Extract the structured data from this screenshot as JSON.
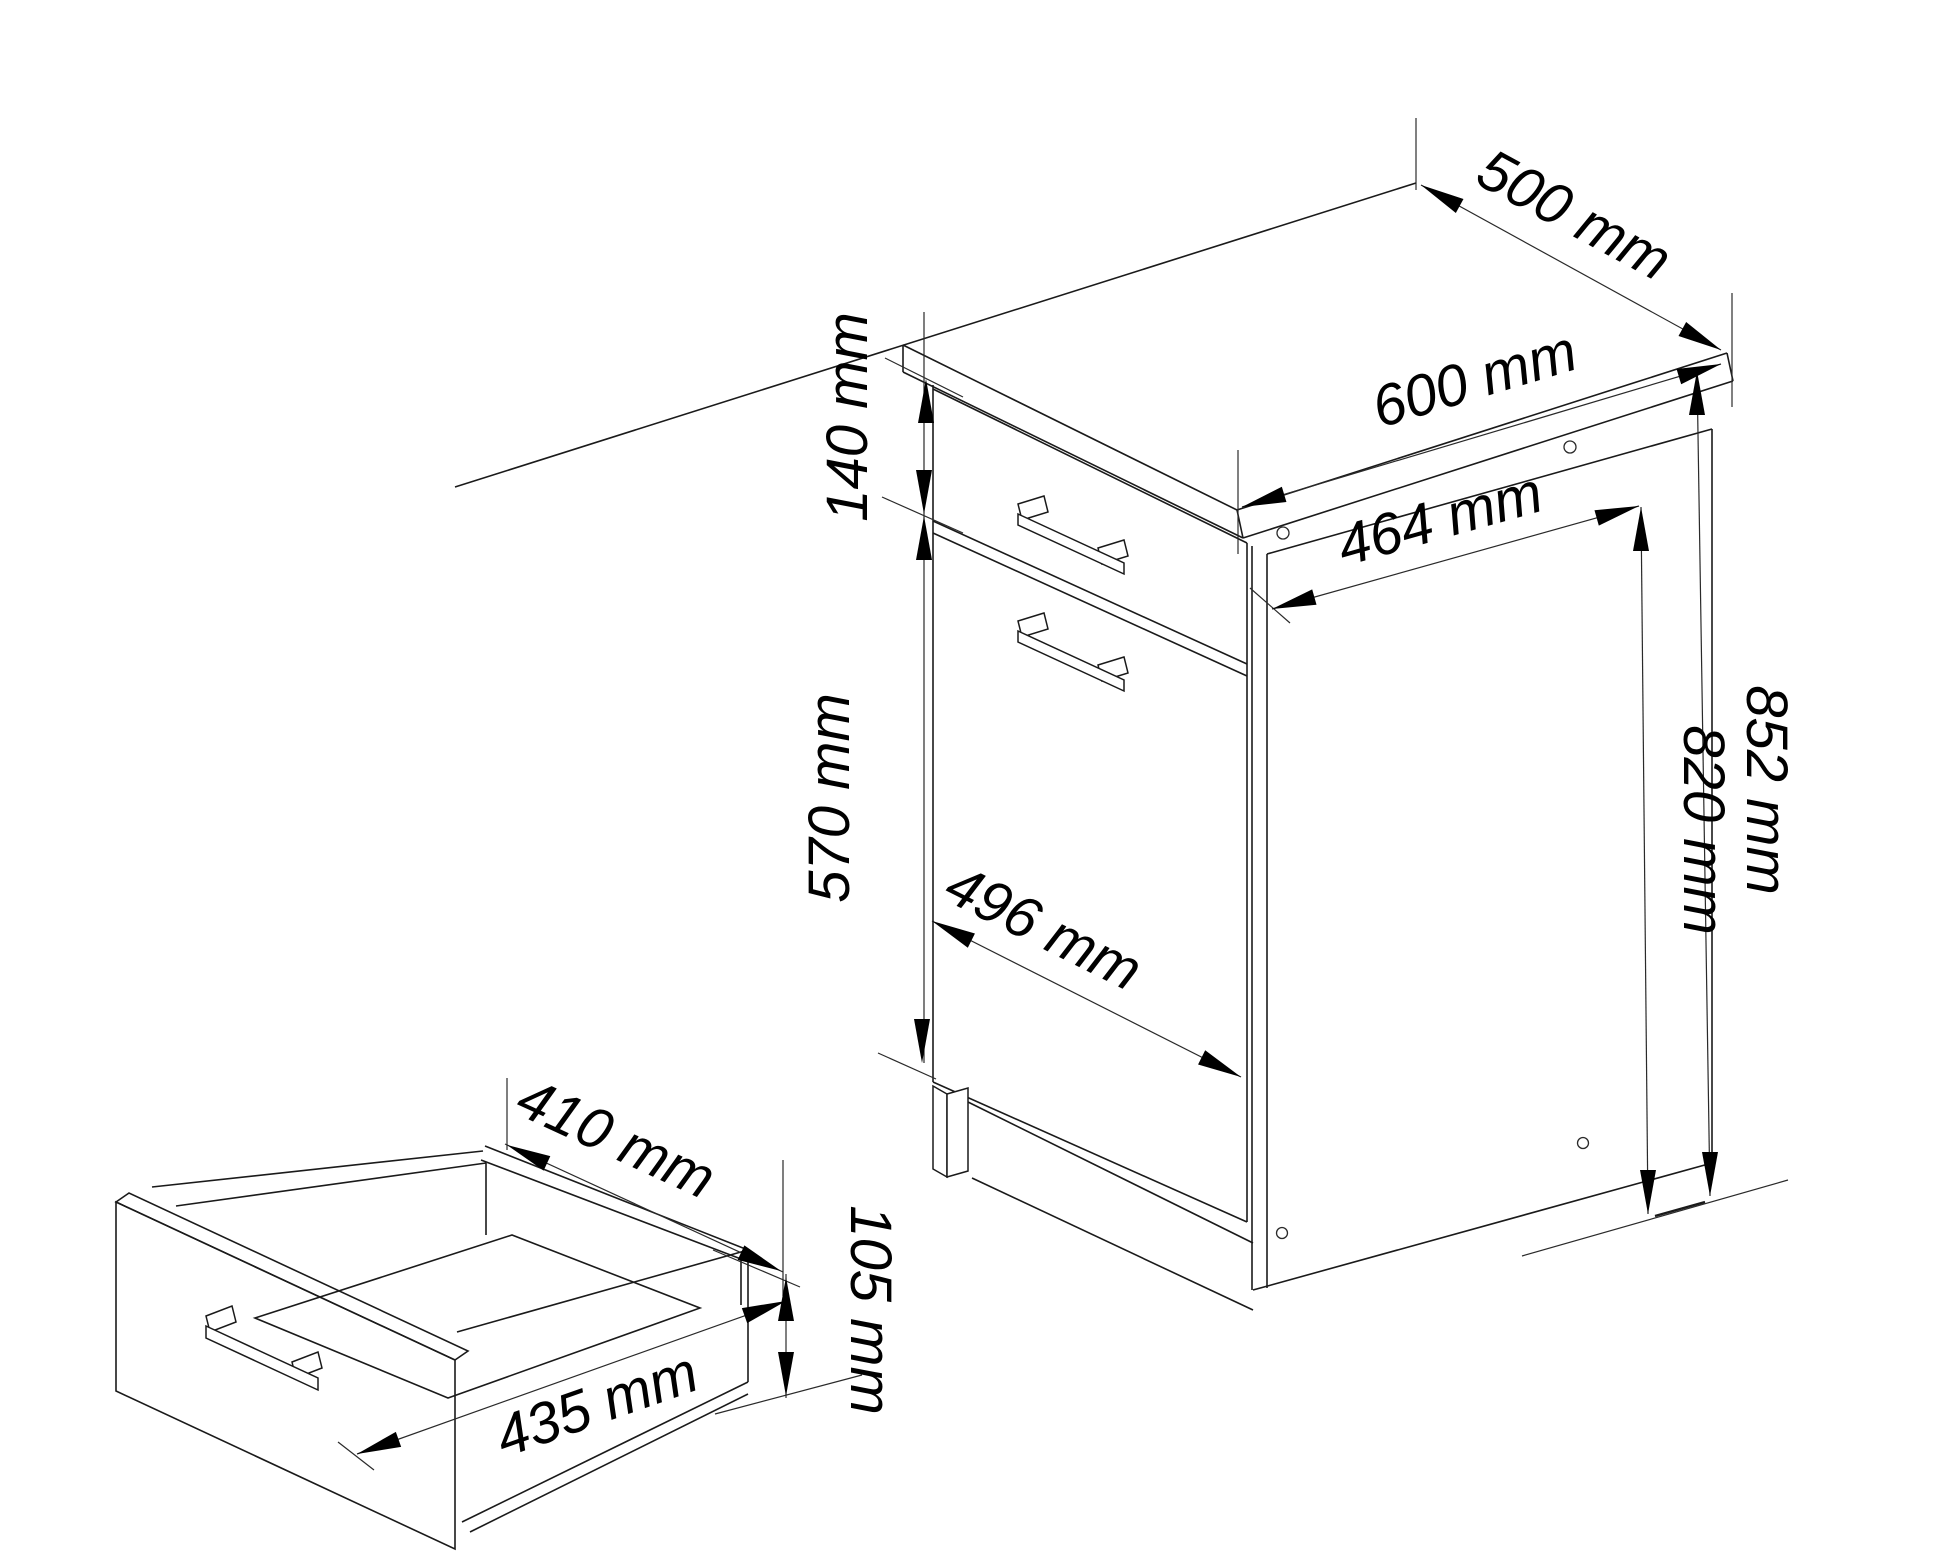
{
  "diagram": {
    "type": "furniture-dimension-drawing",
    "unit": "mm",
    "background_color": "#ffffff",
    "line_color": "#1a1a1a",
    "main_cabinet": {
      "worktop_width": "500 mm",
      "worktop_depth": "600 mm",
      "side_panel_depth": "464 mm",
      "drawer_front_height": "140 mm",
      "door_height": "570 mm",
      "front_width": "496 mm",
      "total_height": "852 mm",
      "carcass_side_height": "820 mm"
    },
    "drawer_box": {
      "inner_depth": "410 mm",
      "inner_width": "435 mm",
      "side_height": "105 mm"
    }
  }
}
